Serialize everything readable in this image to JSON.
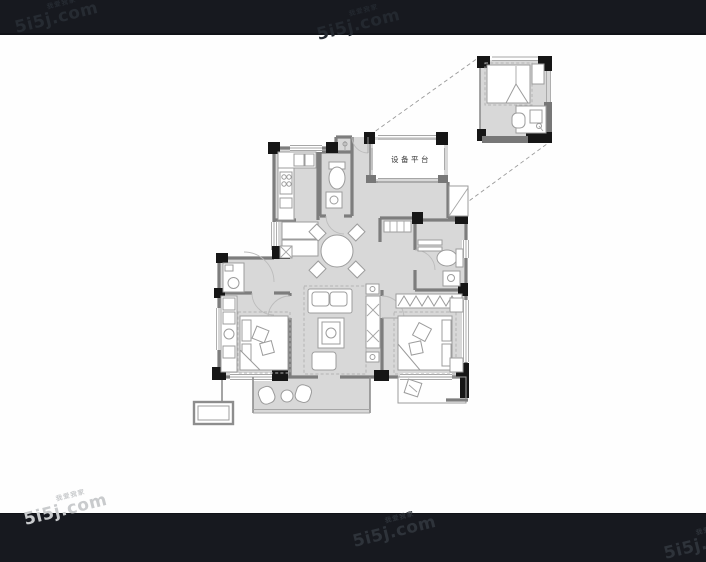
{
  "watermark": {
    "brand": "5i5j.com",
    "slogan": "我爱我家"
  },
  "floorplan": {
    "labels": {
      "equipment_platform": "设备平台"
    }
  },
  "colors": {
    "letterbox_bar": "#17191f",
    "background": "#ffffff",
    "floor_fill": "#d8d8d8",
    "wall_gray": "#7d7d7d",
    "column_black": "#161616",
    "furniture_line": "#9c9c9c",
    "watermark_on_dark": "#2e333a",
    "watermark_on_light": "#c9cbcd"
  }
}
